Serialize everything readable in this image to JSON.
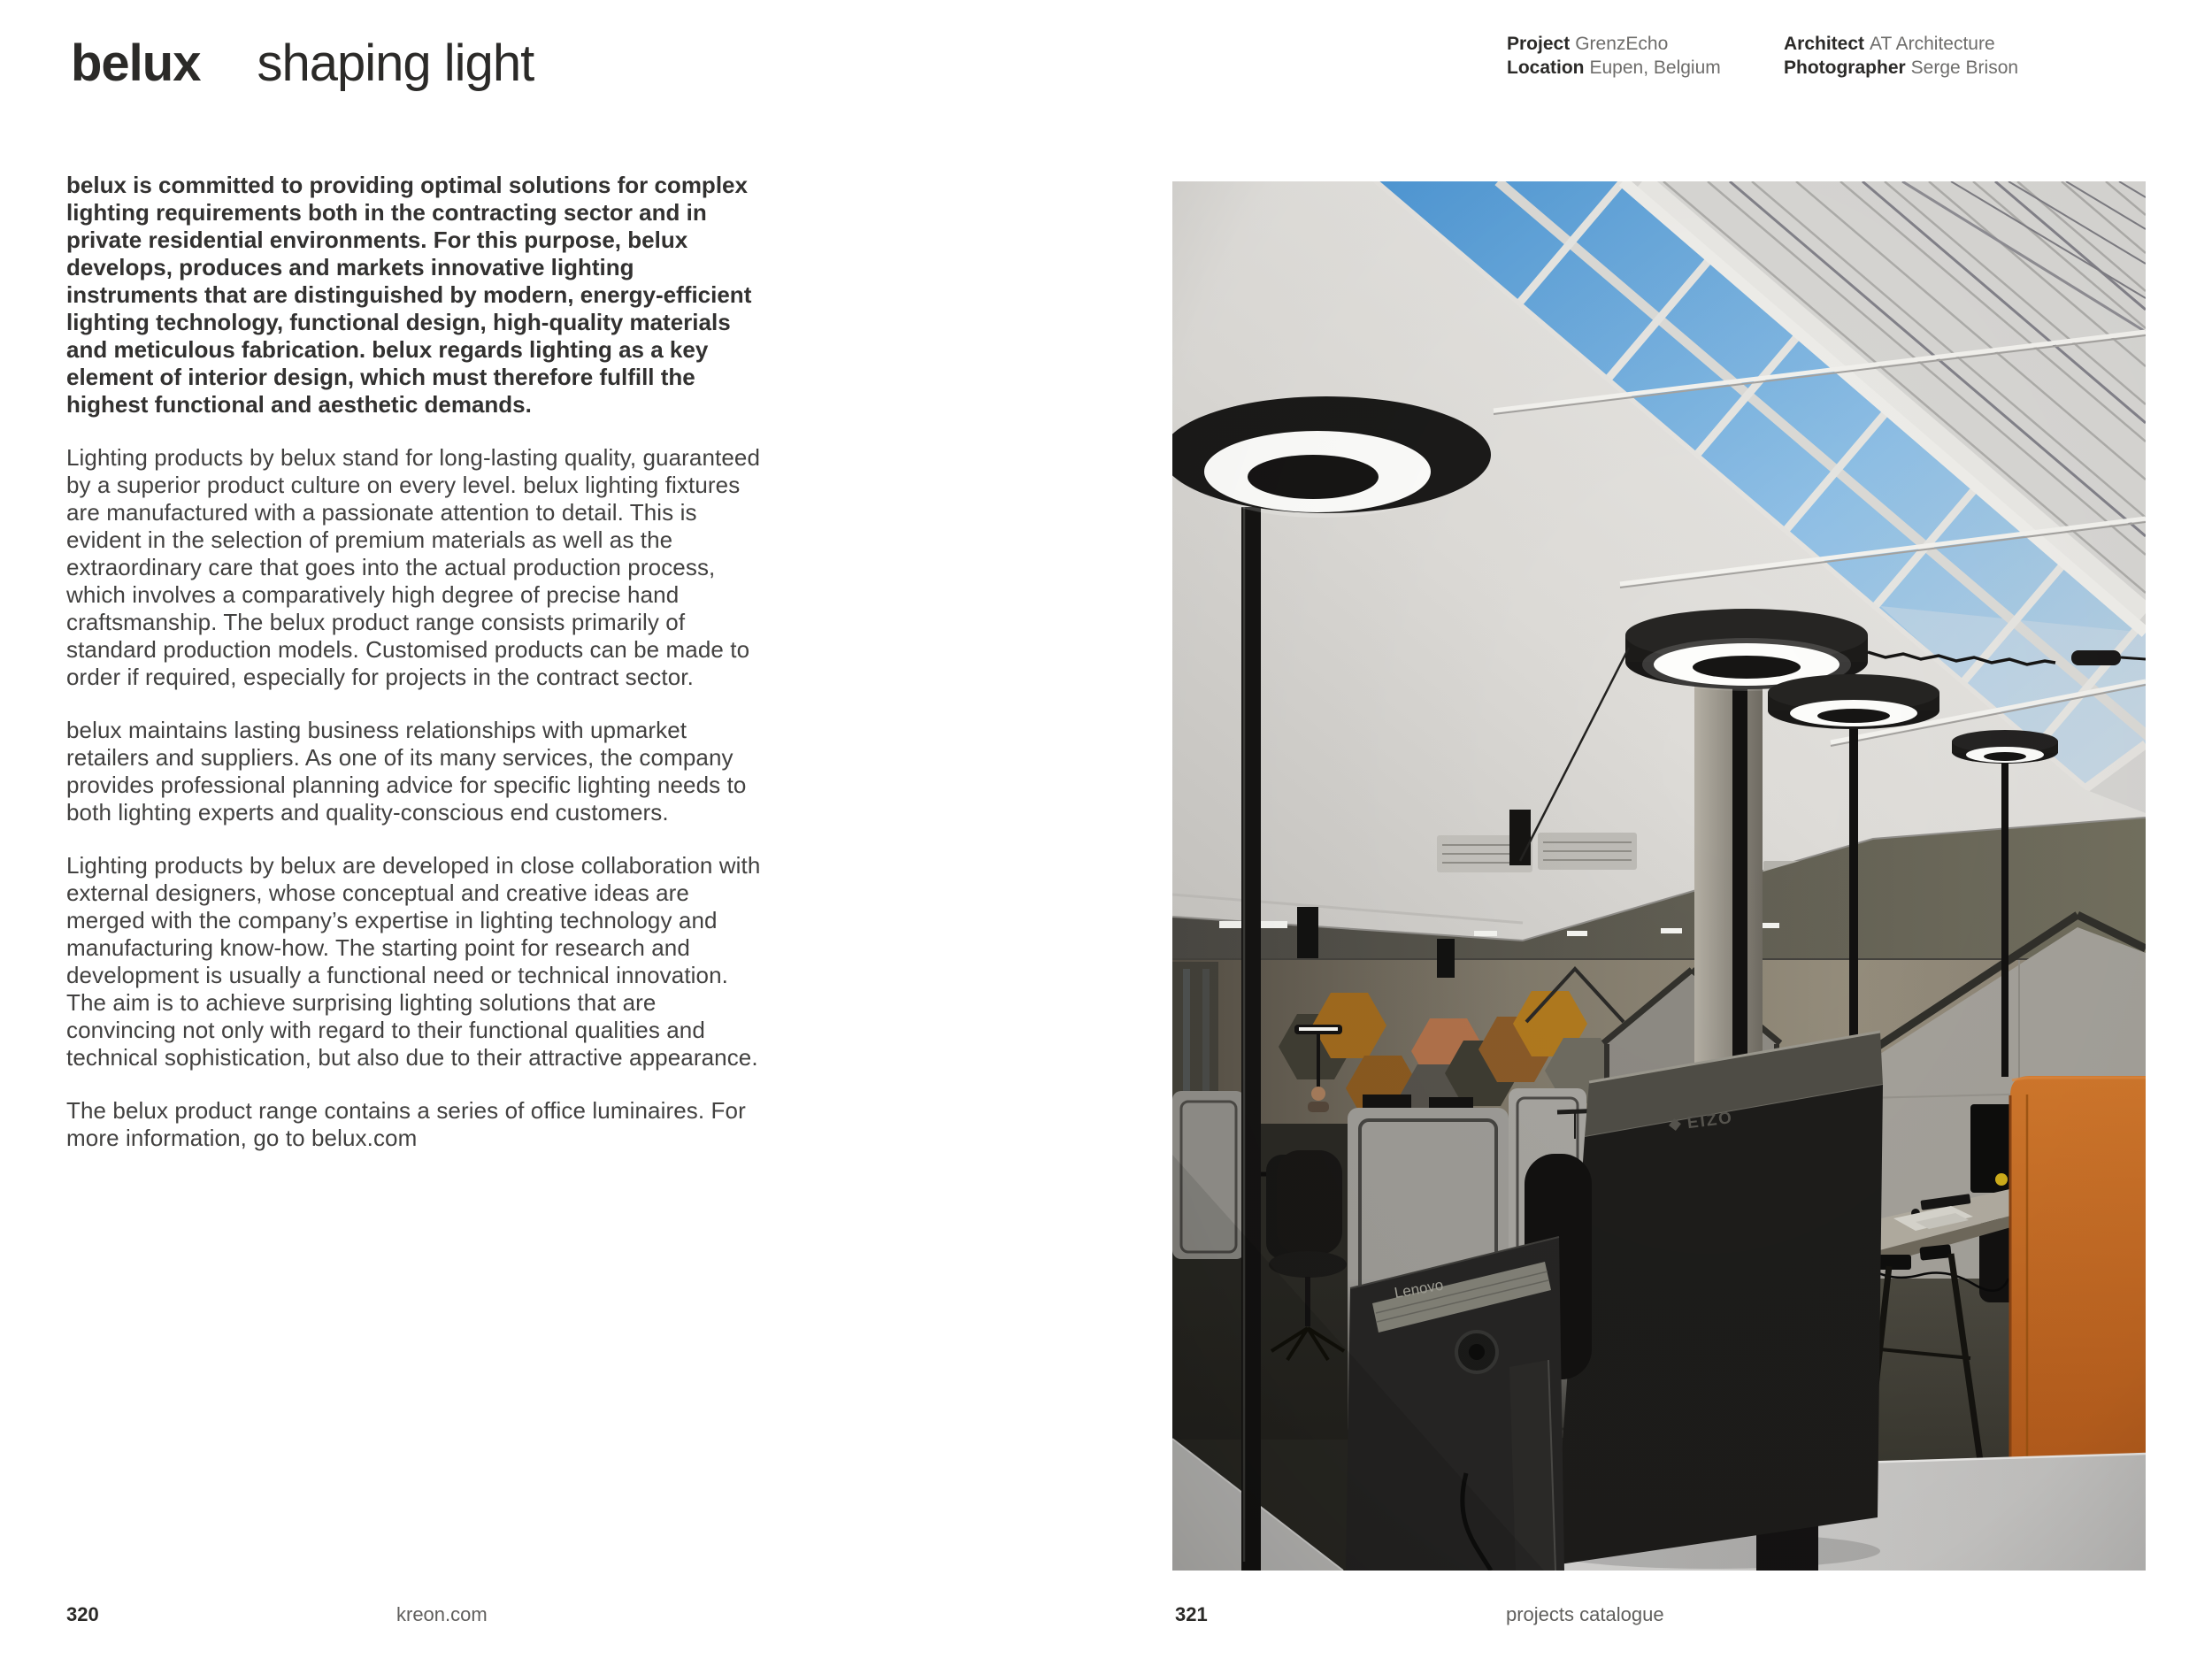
{
  "header": {
    "brand": "belux",
    "tagline": "shaping light"
  },
  "project_meta": {
    "columns": [
      {
        "rows": [
          {
            "label": "Project",
            "value": "GrenzEcho"
          },
          {
            "label": "Location",
            "value": "Eupen, Belgium"
          }
        ]
      },
      {
        "rows": [
          {
            "label": "Architect",
            "value": "AT Architecture"
          },
          {
            "label": "Photographer",
            "value": "Serge Brison"
          }
        ]
      }
    ]
  },
  "body": {
    "paragraphs": [
      {
        "emphasis": true,
        "text": "belux is committed to providing optimal solutions for complex lighting requirements both in the contracting sector and in private residential environments. For this purpose, belux develops, produces and markets innovative lighting instruments that are distinguished by modern, energy-efficient lighting technology, functional design, high-quality materials and meticulous fabrication. belux regards lighting as a key element of interior design, which must therefore fulfill the highest functional and aesthetic demands."
      },
      {
        "emphasis": false,
        "text": "Lighting products by belux stand for long-lasting quality, guaranteed by a superior product culture on every level. belux lighting fixtures are manufactured with a passionate attention to detail. This is evident in the selection of premium materials as well as the extraordinary care that goes into the actual production process, which involves a comparatively high degree of precise hand craftsmanship. The belux product range consists primarily of standard production models. Customised products can be made to order if required, especially for projects in the contract sector."
      },
      {
        "emphasis": false,
        "text": "belux maintains lasting business relationships with upmarket retailers and suppliers. As one of its many services, the company provides professional planning advice for specific lighting needs to both lighting experts and quality-conscious end customers."
      },
      {
        "emphasis": false,
        "text": "Lighting products by belux are developed in close collaboration with external designers, whose conceptual and creative ideas are merged with the company’s expertise in lighting technology and manufacturing know-how. The starting point for research and development is usually a functional need or technical innovation. The aim is to achieve surprising lighting solutions that are convincing not only with regard to their functional qualities and technical sophistication, but also due to their attractive appearance."
      },
      {
        "emphasis": false,
        "text": "The belux product range contains a series of office luminaires. For more information, go to belux.com"
      }
    ]
  },
  "photo": {
    "labels": {
      "monitor_left": "Lenovo",
      "monitor_right": "EIZO"
    },
    "colors": {
      "sky": "#6babdf",
      "roof_white": "#dddbd7",
      "back_wall": "#8d8678",
      "hex_ochre": "#a9701f",
      "hex_rust": "#8a5a20",
      "hex_salmon": "#b0714a",
      "hex_olive": "#3f3d33",
      "hex_gray": "#6e6b60",
      "orange_pod": "#c2651f",
      "felt_gray": "#a5a29b",
      "lamp_black": "#1b1a19",
      "lamp_glow": "#ffffff"
    }
  },
  "footer": {
    "left": {
      "page": "320",
      "site": "kreon.com"
    },
    "right": {
      "page": "321",
      "label": "projects catalogue"
    }
  }
}
